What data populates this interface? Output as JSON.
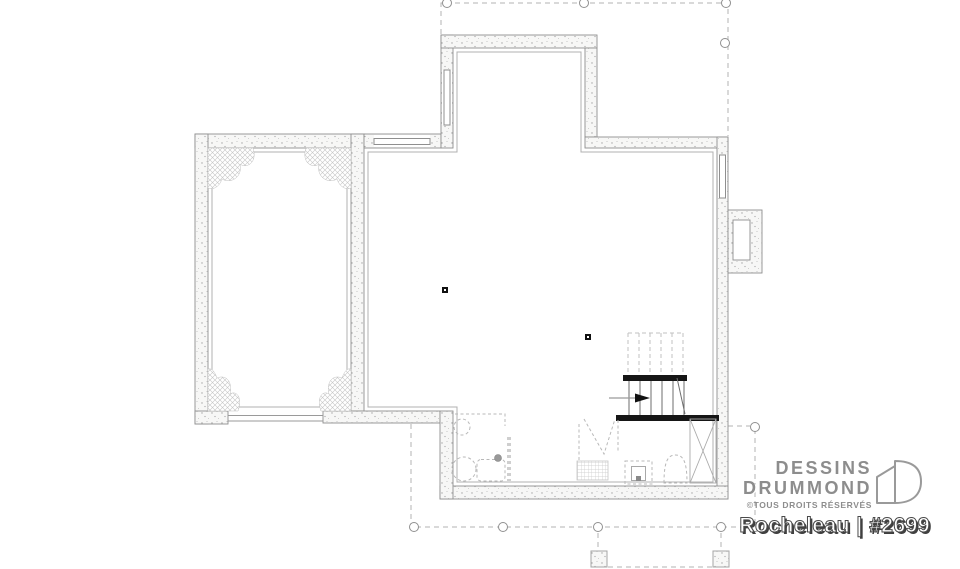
{
  "brand": {
    "line1": "DESSINS",
    "line2": "DRUMMOND",
    "copyright": "©TOUS DROITS RÉSERVÉS",
    "logo_icon": "drummond-d-icon"
  },
  "plan_label": {
    "title": "Rocheleau | #2699",
    "model_name": "Rocheleau",
    "plan_number": "#2699"
  },
  "colors": {
    "background": "#ffffff",
    "wall_outline": "#8f8f8f",
    "wall_fill": "#f7f7f6",
    "stair_bar": "#161616",
    "dashed_line": "#b5b5b5",
    "hatch": "#c6c6c6",
    "brand_gray": "#8d8d8d",
    "title_text": "#ffffff",
    "title_shadow": "#3f3f3f"
  }
}
